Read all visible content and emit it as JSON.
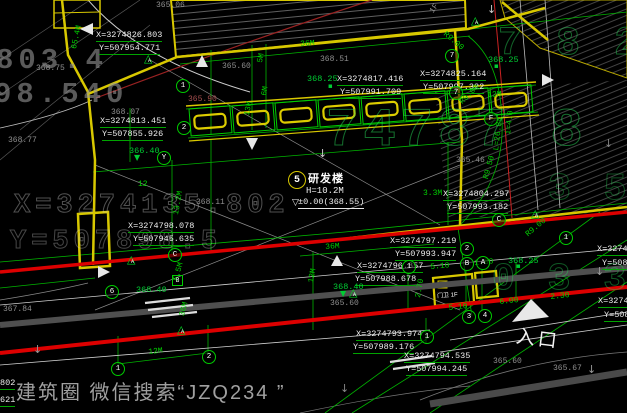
{
  "watermark": {
    "text": "建筑圈 微信搜索“JZQ234 ”"
  },
  "entrance": {
    "label": "入口"
  },
  "building": {
    "bubble": "5",
    "name": "研发楼",
    "height": "H=10.2M",
    "level": "±0.00(368.55)"
  },
  "guard_house": {
    "label": "门卫 1F"
  },
  "triangle_glyph": "△",
  "colors": {
    "boundary_yellow": "#d8c800",
    "red_line": "#dd0000",
    "green": "#00cc00",
    "gray_road": "#555555",
    "white": "#ececec",
    "background": "#000000"
  },
  "coords": [
    {
      "text": "X=3274826.803",
      "x": 96,
      "y": 30
    },
    {
      "text": "Y=507954.771",
      "x": 99,
      "y": 43
    },
    {
      "text": "X=3274813.451",
      "x": 100,
      "y": 116
    },
    {
      "text": "Y=507855.926",
      "x": 102,
      "y": 129
    },
    {
      "text": "X=3274817.416",
      "x": 337,
      "y": 74
    },
    {
      "text": "Y=507991.709",
      "x": 340,
      "y": 87
    },
    {
      "text": "X=3274825.164",
      "x": 420,
      "y": 69
    },
    {
      "text": "Y=507997.322",
      "x": 423,
      "y": 82
    },
    {
      "text": "X=3274804.297",
      "x": 443,
      "y": 189
    },
    {
      "text": "Y=507993.182",
      "x": 447,
      "y": 202
    },
    {
      "text": "X=3274798.078",
      "x": 128,
      "y": 221
    },
    {
      "text": "Y=507945.635",
      "x": 133,
      "y": 234
    },
    {
      "text": "X=3274797.219",
      "x": 390,
      "y": 236
    },
    {
      "text": "Y=507993.947",
      "x": 395,
      "y": 249
    },
    {
      "text": "X=3274796.857",
      "x": 357,
      "y": 261
    },
    {
      "text": "Y=507988.678",
      "x": 355,
      "y": 274
    },
    {
      "text": "X=3274793.974",
      "x": 356,
      "y": 329
    },
    {
      "text": "Y=507989.176",
      "x": 353,
      "y": 342
    },
    {
      "text": "X=3274794.535",
      "x": 404,
      "y": 351
    },
    {
      "text": "Y=507994.245",
      "x": 406,
      "y": 364
    },
    {
      "text": "X=32747",
      "x": 597,
      "y": 244
    },
    {
      "text": "Y=5088",
      "x": 602,
      "y": 258
    },
    {
      "text": "X=32747",
      "x": 598,
      "y": 296
    },
    {
      "text": "Y=5088",
      "x": 604,
      "y": 310
    },
    {
      "text": "802",
      "x": 0,
      "y": 378
    },
    {
      "text": "621",
      "x": 0,
      "y": 395
    }
  ],
  "elev_green": [
    {
      "text": "368.25",
      "x": 307,
      "y": 74
    },
    {
      "text": "368.25",
      "x": 488,
      "y": 55
    },
    {
      "text": "368.25",
      "x": 508,
      "y": 256
    },
    {
      "text": "366.40",
      "x": 129,
      "y": 146
    },
    {
      "text": "368.40",
      "x": 333,
      "y": 282
    },
    {
      "text": "368.40",
      "x": 136,
      "y": 285
    }
  ],
  "elev_gray": [
    {
      "text": "365.06",
      "x": 156,
      "y": 1
    },
    {
      "text": "368.75",
      "x": 36,
      "y": 64
    },
    {
      "text": "368.07",
      "x": 111,
      "y": 108
    },
    {
      "text": "365.60",
      "x": 222,
      "y": 62
    },
    {
      "text": "368.51",
      "x": 320,
      "y": 55
    },
    {
      "text": "368.77",
      "x": 8,
      "y": 136
    },
    {
      "text": "365.90",
      "x": 188,
      "y": 95,
      "red": true
    },
    {
      "text": "365.46",
      "x": 456,
      "y": 156
    },
    {
      "text": "368.11",
      "x": 196,
      "y": 198
    },
    {
      "text": "367.84",
      "x": 3,
      "y": 305
    },
    {
      "text": "365.60",
      "x": 330,
      "y": 299
    },
    {
      "text": "365.60",
      "x": 493,
      "y": 357
    },
    {
      "text": "365.67",
      "x": 553,
      "y": 364
    },
    {
      "text": "1F",
      "x": 428,
      "y": 10,
      "rot": -55
    }
  ],
  "dims": [
    {
      "text": "65.4M",
      "x": 70,
      "y": 48,
      "rot": -78
    },
    {
      "text": "36M",
      "x": 300,
      "y": 40,
      "rot": -4
    },
    {
      "text": "5M",
      "x": 256,
      "y": 62,
      "rot": -80
    },
    {
      "text": "6M",
      "x": 260,
      "y": 95,
      "rot": -80
    },
    {
      "text": "13M",
      "x": 243,
      "y": 115,
      "rot": -80
    },
    {
      "text": "12",
      "x": 138,
      "y": 180
    },
    {
      "text": "12M",
      "x": 487,
      "y": 91,
      "rot": -4
    },
    {
      "text": "R9.00",
      "x": 447,
      "y": 30,
      "rot": 40
    },
    {
      "text": "R9.00",
      "x": 458,
      "y": 100,
      "rot": -45
    },
    {
      "text": "13.2M",
      "x": 172,
      "y": 214,
      "rot": -80
    },
    {
      "text": "3.3M",
      "x": 423,
      "y": 189
    },
    {
      "text": "L=26.84",
      "x": 492,
      "y": 150,
      "rot": -83
    },
    {
      "text": "i=4.0",
      "x": 504,
      "y": 134,
      "rot": -83
    },
    {
      "text": "R9.50",
      "x": 482,
      "y": 178,
      "rot": -75
    },
    {
      "text": "R9.00",
      "x": 524,
      "y": 232,
      "rot": -40
    },
    {
      "text": "36M",
      "x": 325,
      "y": 243,
      "rot": -4
    },
    {
      "text": "12M",
      "x": 307,
      "y": 282,
      "rot": -80
    },
    {
      "text": "5.5M",
      "x": 172,
      "y": 280,
      "rot": -75
    },
    {
      "text": "36M",
      "x": 178,
      "y": 315,
      "rot": -75
    },
    {
      "text": "5.10",
      "x": 430,
      "y": 263,
      "rot": -5
    },
    {
      "text": "1.80",
      "x": 474,
      "y": 259,
      "rot": -5
    },
    {
      "text": "2.70",
      "x": 414,
      "y": 297,
      "rot": -80
    },
    {
      "text": "5.10",
      "x": 448,
      "y": 304,
      "rot": -6
    },
    {
      "text": "6.00",
      "x": 499,
      "y": 298,
      "rot": -6
    },
    {
      "text": "2.30",
      "x": 550,
      "y": 293,
      "rot": -6
    },
    {
      "text": "12M",
      "x": 148,
      "y": 348,
      "rot": -6
    }
  ],
  "bubbles": [
    {
      "t": "1",
      "x": 176,
      "y": 79
    },
    {
      "t": "2",
      "x": 177,
      "y": 121
    },
    {
      "t": "Y",
      "x": 157,
      "y": 151
    },
    {
      "t": "7",
      "x": 445,
      "y": 49
    },
    {
      "t": "7",
      "x": 449,
      "y": 86
    },
    {
      "t": "F",
      "x": 484,
      "y": 112
    },
    {
      "t": "1",
      "x": 559,
      "y": 231
    },
    {
      "t": "C",
      "x": 492,
      "y": 213
    },
    {
      "t": "C",
      "x": 168,
      "y": 248
    },
    {
      "t": "6",
      "x": 105,
      "y": 285
    },
    {
      "t": "1",
      "x": 402,
      "y": 260
    },
    {
      "t": "B",
      "x": 460,
      "y": 257
    },
    {
      "t": "A",
      "x": 476,
      "y": 256
    },
    {
      "t": "2",
      "x": 460,
      "y": 242
    },
    {
      "t": "3",
      "x": 462,
      "y": 310
    },
    {
      "t": "4",
      "x": 478,
      "y": 309
    },
    {
      "t": "1",
      "x": 420,
      "y": 330
    },
    {
      "t": "1",
      "x": 111,
      "y": 362
    },
    {
      "t": "2",
      "x": 202,
      "y": 350
    }
  ],
  "triangles": [
    {
      "t": "A",
      "x": 144,
      "y": 54
    },
    {
      "t": "A",
      "x": 471,
      "y": 16
    },
    {
      "t": "A",
      "x": 531,
      "y": 209
    },
    {
      "t": "A",
      "x": 127,
      "y": 255
    },
    {
      "t": "A",
      "x": 177,
      "y": 325
    },
    {
      "t": "A",
      "x": 349,
      "y": 288
    }
  ],
  "squares": [
    {
      "t": "B",
      "x": 172,
      "y": 275
    }
  ],
  "markers": [
    {
      "text": "▼",
      "x": 134,
      "y": 154,
      "color": "#00cc33",
      "size": 8
    },
    {
      "text": "▼",
      "x": 340,
      "y": 290,
      "color": "#00cc33",
      "size": 8
    },
    {
      "text": "▽",
      "x": 292,
      "y": 199,
      "color": "#e8e8e8",
      "size": 9
    },
    {
      "text": "▪",
      "x": 328,
      "y": 83,
      "color": "#00cc33",
      "size": 7
    },
    {
      "text": "▪",
      "x": 494,
      "y": 63,
      "color": "#00cc33",
      "size": 7
    },
    {
      "text": "▪",
      "x": 516,
      "y": 263,
      "color": "#00cc33",
      "size": 7
    },
    {
      "text": "↓",
      "x": 318,
      "y": 148,
      "color": "#cccccc",
      "size": 11
    },
    {
      "text": "↓",
      "x": 595,
      "y": 266,
      "color": "#999999",
      "size": 11
    },
    {
      "text": "↓",
      "x": 587,
      "y": 364,
      "color": "#999999",
      "size": 11
    },
    {
      "text": "↓",
      "x": 33,
      "y": 344,
      "color": "#999999",
      "size": 11
    },
    {
      "text": "↓",
      "x": 487,
      "y": 4,
      "color": "#cccccc",
      "size": 11
    },
    {
      "text": "↓",
      "x": 340,
      "y": 383,
      "color": "#888888",
      "size": 11
    },
    {
      "text": "↓",
      "x": 604,
      "y": 138,
      "color": "#888888",
      "size": 11
    }
  ],
  "underlay": [
    {
      "text": "803.4",
      "x": -4,
      "y": 46,
      "size": 29,
      "color": "rgba(150,150,150,0.60)"
    },
    {
      "text": "98.540",
      "x": -6,
      "y": 80,
      "size": 29,
      "color": "rgba(150,150,150,0.60)"
    },
    {
      "text": "X=3274135.802",
      "x": 14,
      "y": 192,
      "size": 27,
      "stroke": "rgba(200,200,200,0.40)"
    },
    {
      "text": "Y=507898.5",
      "x": 10,
      "y": 228,
      "size": 27,
      "stroke": "rgba(200,200,200,0.35)"
    },
    {
      "text": "74787 8",
      "x": 326,
      "y": 104,
      "size": 54,
      "stroke": "rgba(40,220,90,0.50)"
    },
    {
      "text": "7 8 2",
      "x": 498,
      "y": 24,
      "size": 40,
      "stroke": "rgba(40,220,90,0.45)"
    },
    {
      "text": "0 3 3",
      "x": 492,
      "y": 260,
      "size": 38,
      "stroke": "rgba(40,220,90,0.40)"
    },
    {
      "text": "3 5 8",
      "x": 548,
      "y": 170,
      "size": 38,
      "stroke": "rgba(40,220,90,0.35)"
    }
  ]
}
